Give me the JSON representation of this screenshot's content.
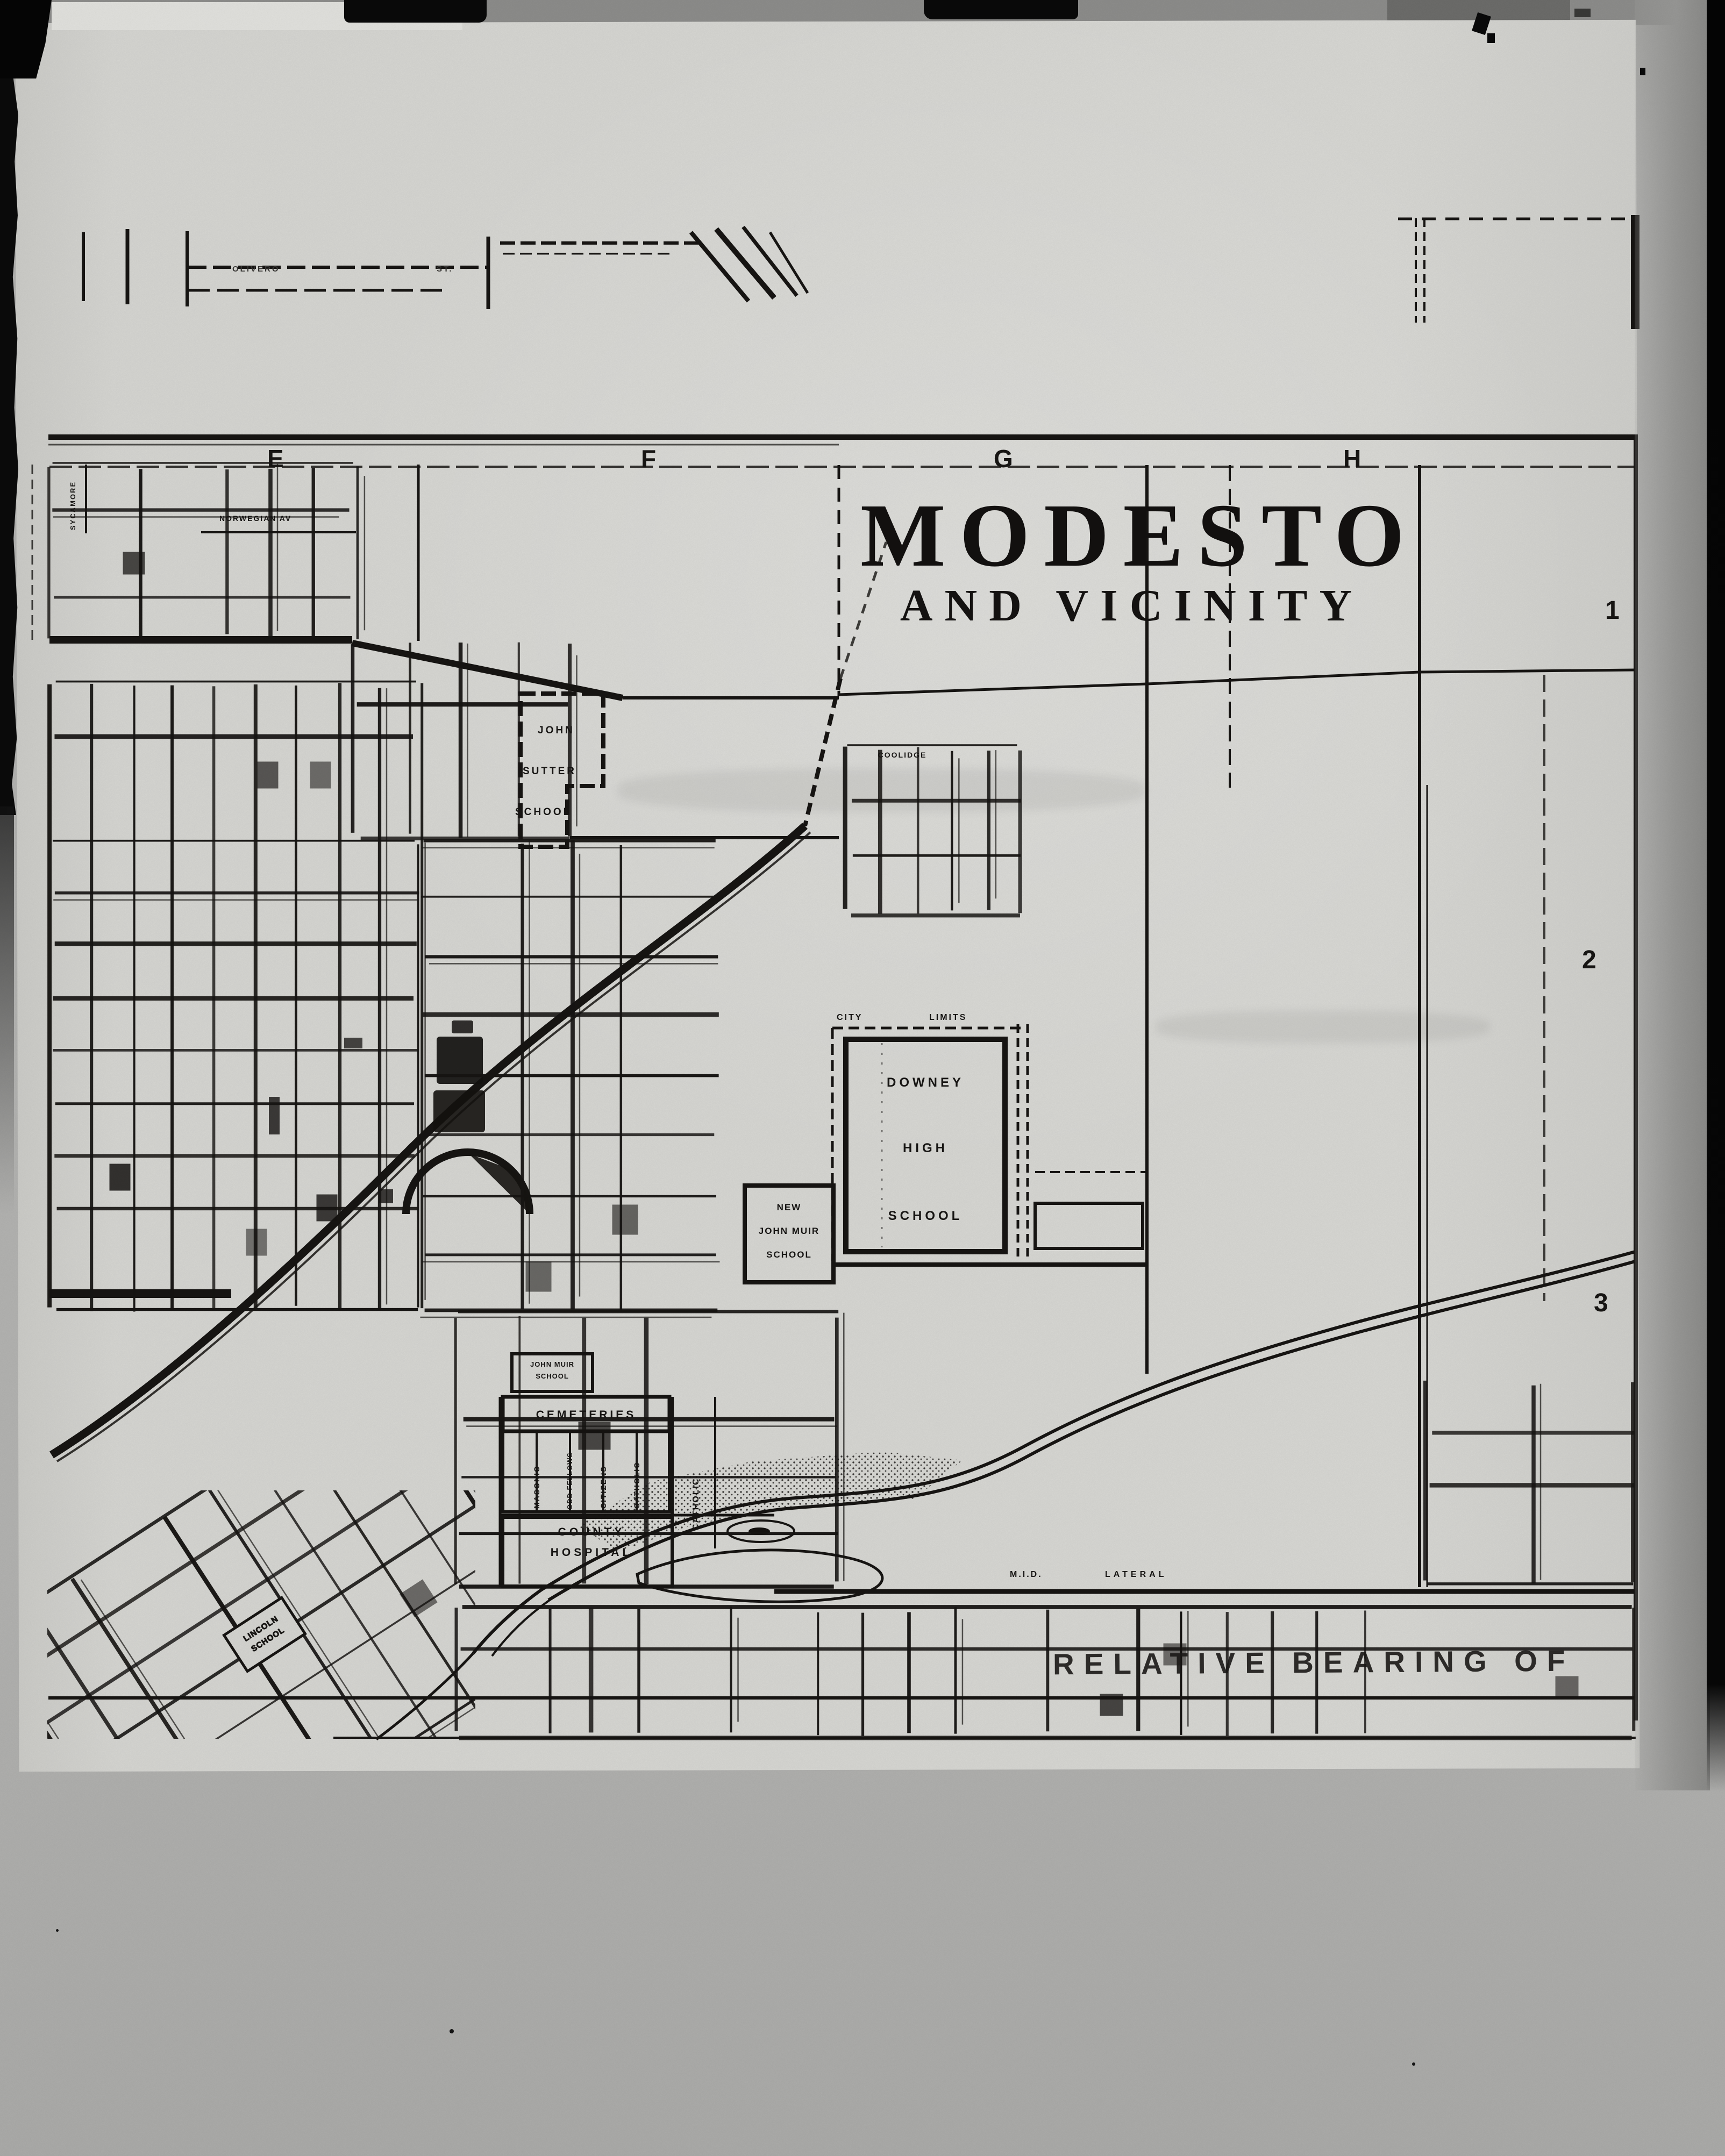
{
  "map": {
    "title": "MODESTO",
    "subtitle": "AND VICINITY",
    "grid_columns": [
      "E",
      "F",
      "G",
      "H"
    ],
    "grid_rows": [
      "1",
      "2",
      "3"
    ],
    "places": {
      "john_sutter": [
        "JOHN",
        "SUTTER",
        "SCHOOL"
      ],
      "downey": [
        "DOWNEY",
        "HIGH",
        "SCHOOL"
      ],
      "new_john_muir": [
        "NEW",
        "JOHN MUIR",
        "SCHOOL"
      ],
      "john_muir": [
        "JOHN MUIR",
        "SCHOOL"
      ],
      "cemeteries": "CEMETERIES",
      "cemetery_sections": [
        "MASONIC",
        "ODD FELLOWS",
        "CITIZENS",
        "CATHOLIC"
      ],
      "catholic_east": "CATHOLIC",
      "county_hospital": [
        "COUNTY",
        "HOSPITAL"
      ],
      "lincoln_school": [
        "LINCOLN",
        "SCHOOL"
      ],
      "city_limits": [
        "CITY",
        "LIMITS"
      ]
    },
    "streets": {
      "norwegian": "NORWEGIAN AV",
      "sycamore": "SYCAMORE",
      "coolidge": "COOLIDGE",
      "mid_lateral": [
        "M.I.D.",
        "LATERAL"
      ],
      "olivero": "OLIVERO",
      "olivero_st": "ST."
    }
  },
  "caption": {
    "text": "RELATIVE BEARING OF"
  }
}
